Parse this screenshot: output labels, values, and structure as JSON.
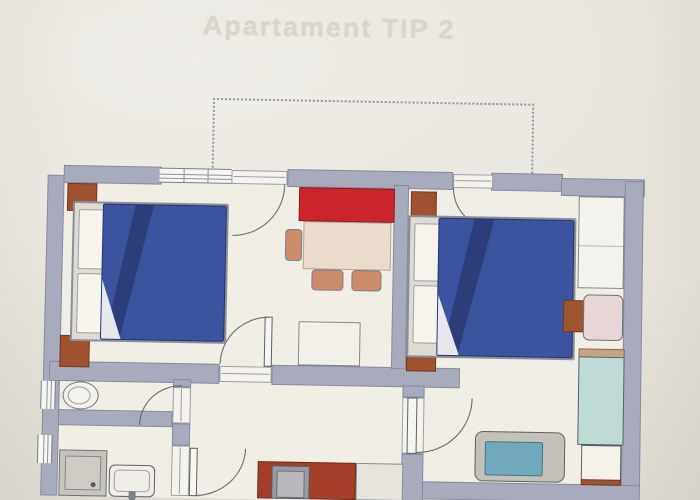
{
  "title": "Apartament TIP 2",
  "plan": {
    "type": "apartment-floor-plan-photo",
    "rooms": [
      {
        "id": "bedroom-1",
        "position": "top-left"
      },
      {
        "id": "living-dining",
        "position": "top-center"
      },
      {
        "id": "bedroom-2",
        "position": "right"
      },
      {
        "id": "wc",
        "position": "middle-left"
      },
      {
        "id": "bathroom",
        "position": "bottom-left"
      },
      {
        "id": "kitchen-hall",
        "position": "bottom-center"
      },
      {
        "id": "balcony",
        "position": "top",
        "style": "dotted-railing"
      }
    ],
    "furniture": [
      {
        "id": "double-bed-1",
        "room": "bedroom-1",
        "color": "#3c53a0"
      },
      {
        "id": "nightstand",
        "room": "bedroom-1",
        "count": 2,
        "color": "#a0512f"
      },
      {
        "id": "sofa",
        "room": "living-dining",
        "color": "#c9252b"
      },
      {
        "id": "dining-table",
        "room": "living-dining",
        "color": "#e9dccd"
      },
      {
        "id": "chair",
        "room": "living-dining",
        "count": 3,
        "color": "#cd8c6a"
      },
      {
        "id": "sideboard",
        "room": "living-dining",
        "color": "#f2f0e8"
      },
      {
        "id": "double-bed-2",
        "room": "bedroom-2",
        "color": "#3c53a0"
      },
      {
        "id": "nightstand",
        "room": "bedroom-2",
        "count": 2,
        "color": "#a0512f"
      },
      {
        "id": "wardrobe",
        "room": "bedroom-2",
        "color": "#f4f2ec"
      },
      {
        "id": "armchair",
        "room": "bedroom-2",
        "color": "#e8d5d5"
      },
      {
        "id": "side-table",
        "room": "bedroom-2",
        "color": "#9c552f"
      },
      {
        "id": "single-bed",
        "room": "bedroom-2",
        "color": "#bedbd5"
      },
      {
        "id": "bench-sofa",
        "room": "bedroom-2",
        "color": "#71a9bd"
      },
      {
        "id": "kitchen-counter",
        "room": "kitchen-hall",
        "color": "#a43e28"
      },
      {
        "id": "stove-unit",
        "room": "kitchen-hall",
        "color": "#9b9aa2"
      },
      {
        "id": "counter-unit",
        "room": "kitchen-hall",
        "color": "#e5e3dc"
      },
      {
        "id": "toilet",
        "room": "wc",
        "color": "#f4f2ec"
      },
      {
        "id": "shower-tray",
        "room": "bathroom",
        "color": "#c6c4bd"
      },
      {
        "id": "sink",
        "room": "bathroom",
        "color": "#f0eee7"
      }
    ],
    "doors": 6,
    "windows": 3,
    "colors": {
      "paper": "#e9e6de",
      "floor": "#f1eee6",
      "wall": "#a7abbb",
      "door_line": "#5c6068",
      "railing": "#8f95a3"
    }
  }
}
